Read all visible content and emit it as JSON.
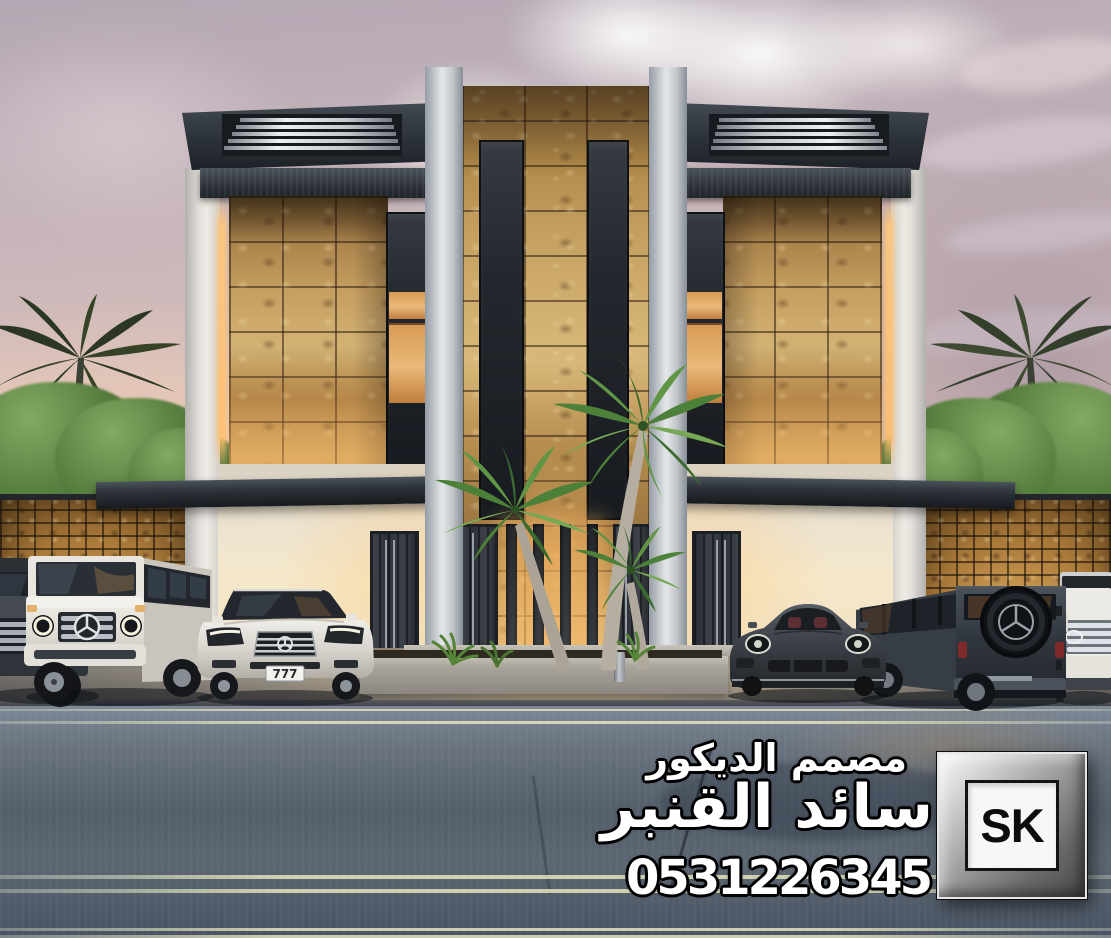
{
  "watermark": {
    "profession": "مصمم الديكور",
    "designer_name": "سائد القنبر",
    "phone": "0531226345",
    "logo_text": "SK"
  },
  "vehicles": {
    "sedan_plate": "777"
  },
  "palette": {
    "sky_top": "#b4a8b4",
    "sky_horizon": "#f7e2ca",
    "stone": "#c5a05f",
    "dark_trim": "#23282e",
    "white_wall": "#e8e5df",
    "cream_wall": "#f0e4cb",
    "warm_glow": "#ffbf6e",
    "road": "#55606e",
    "lane_line": "#dfe1ba",
    "foliage": "#4e7538"
  }
}
